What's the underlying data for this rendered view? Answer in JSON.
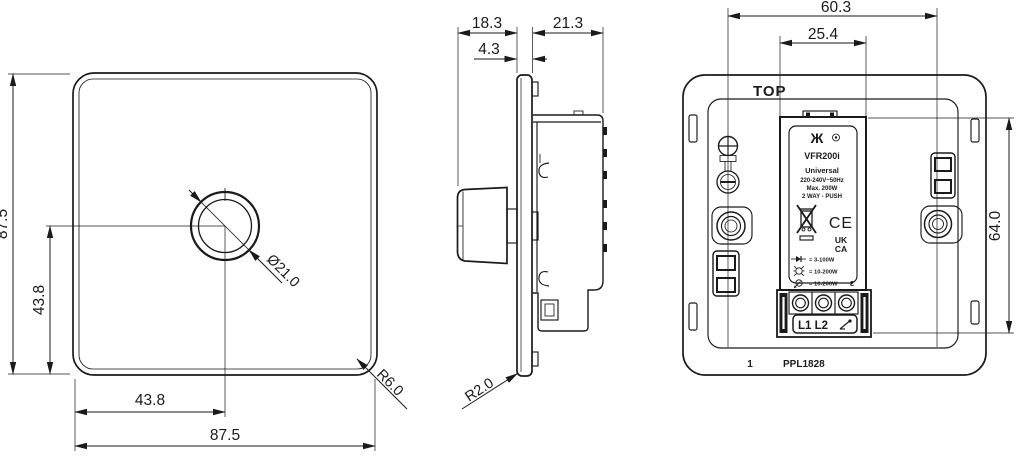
{
  "drawing": {
    "front": {
      "width": "87.5",
      "height": "87.5",
      "center_x": "43.8",
      "center_y": "43.8",
      "knob_dia": "Ø21.0",
      "corner_r": "R6.0"
    },
    "side": {
      "knob_depth": "18.3",
      "plate_thick": "4.3",
      "box_depth": "21.3",
      "edge_r": "R2.0"
    },
    "rear": {
      "top_label": "TOP",
      "fixing_span": "60.3",
      "module_width": "25.4",
      "module_height": "64.0",
      "module": {
        "brand": "Ж",
        "model": "VFR200i",
        "range": "Universal",
        "voltage": "220-240V~50Hz",
        "max_load": "Max. 200W",
        "wiring": "2 WAY - PUSH",
        "ce": "CE",
        "uk": "UK",
        "ca": "CA",
        "cert": "ε",
        "rating_led": "= 3-100W",
        "rating_incandescent": "= 10-200W",
        "rating_halogen": "= 10-200W",
        "terminals": "L1 L2"
      },
      "sheet_no": "1",
      "part_no": "PPL1828"
    }
  }
}
